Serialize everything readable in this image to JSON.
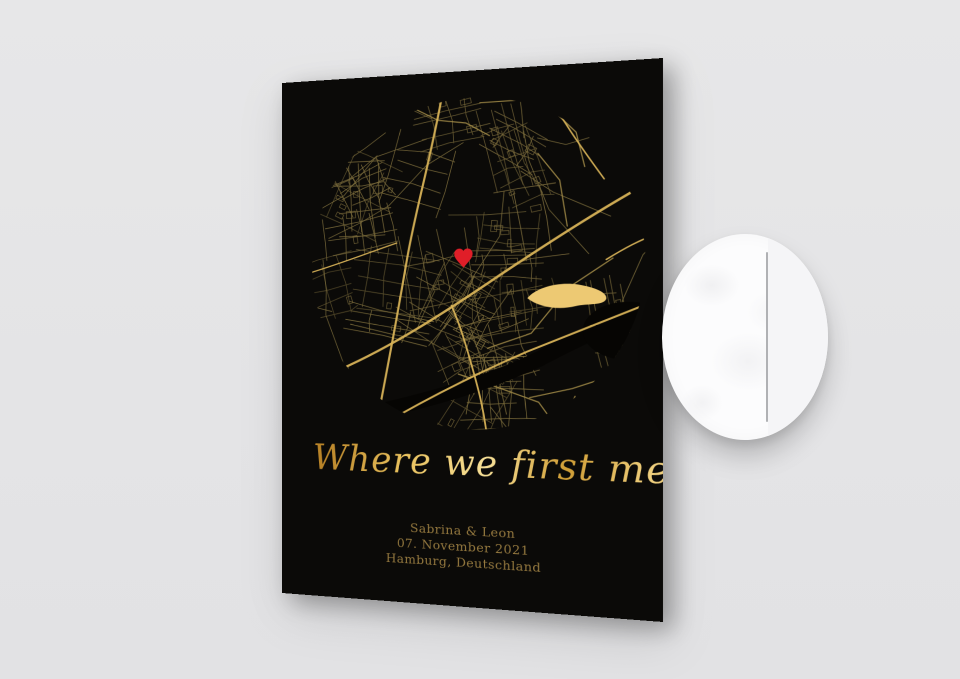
{
  "poster": {
    "title": "Where we first met",
    "names": "Sabrina & Leon",
    "date": "07. November 2021",
    "location": "Hamburg, Deutschland",
    "map": {
      "marker_icon": "heart-icon",
      "water_feature": "lake-shape"
    },
    "colors": {
      "scene_bg": "#e5e5e6",
      "poster_bg": "#0b0a08",
      "street": "#7d6d3c",
      "street_medium": "#a68e49",
      "road_major": "#d7b257",
      "river": "#060503",
      "water": "#edc973",
      "heart": "#e01e28",
      "title_gold": "#e7c266",
      "text_gold": "#95793f",
      "paper": "#fcfcfd",
      "edge_line": "#b0b1b4"
    }
  }
}
